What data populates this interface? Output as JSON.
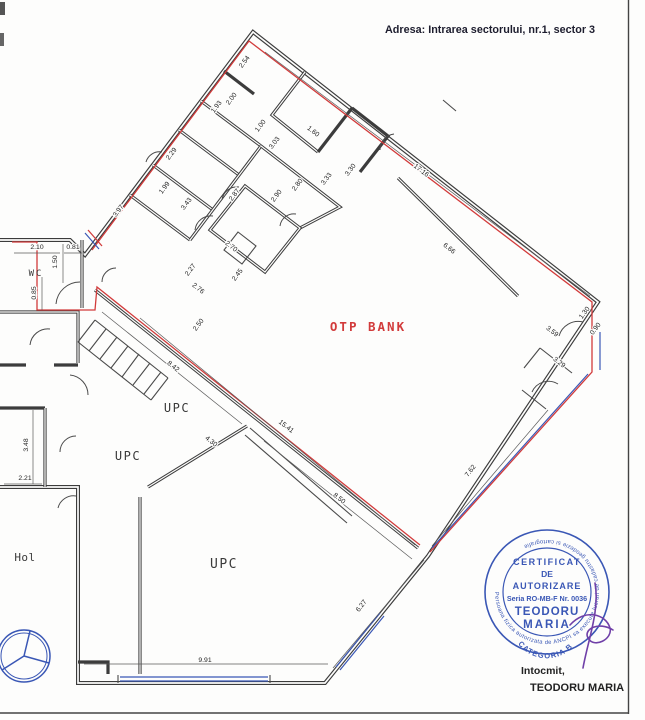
{
  "header": {
    "address": "Adresa: Intrarea sectorului, nr.1, sector 3"
  },
  "rooms": {
    "bank": "OTP BANK",
    "upc_a": "UPC",
    "upc_b": "UPC",
    "upc_c": "UPC",
    "hol": "Hol",
    "wc": "WC"
  },
  "dims": {
    "d01": "3.97",
    "d02": "1.99",
    "d03": "2.29",
    "d04": "1.93",
    "d05": "2.00",
    "d06": "2.54",
    "d07": "17.16",
    "d08": "1.00",
    "d09": "1.60",
    "d10": "3.03",
    "d11": "3.33",
    "d12": "3.30",
    "d13": "2.87",
    "d14": "2.90",
    "d15": "2.80",
    "d16": "3.43",
    "d17": "2.70",
    "d18": "2.45",
    "d19": "2.76",
    "d20": "2.27",
    "d21": "2.50",
    "d22": "8.42",
    "d23": "15.41",
    "d24": "4.30",
    "d25": "8.50",
    "d26": "6.66",
    "d27": "3.59",
    "d28": "3.29",
    "d29": "1.30",
    "d30": "0.90",
    "d31": "7.62",
    "d32": "6.27",
    "d33": "9.91",
    "d34": "2.21",
    "d35": "3.48",
    "d36": "2.10",
    "d37": "0.81",
    "d38": "1.50",
    "d39": "0.85"
  },
  "stamp": {
    "ring": "Persoana fizica autorizata de ANCPI sa execute lucrari de cadastru geodezie si cartografie",
    "line1": "CERTIFICAT",
    "line2": "DE",
    "line3": "AUTORIZARE",
    "line4": "Seria RO-MB-F Nr. 0036",
    "name1": "TEODORU",
    "name2": "MARIA",
    "category": "CATEGORIA B"
  },
  "footer": {
    "prepared_label": "Intocmit,",
    "prepared_name": "TEODORU MARIA"
  },
  "colors": {
    "red": "#d23b3b",
    "blue": "#3a57b5",
    "purple": "#7040a8",
    "ink": "#3c3c3c"
  }
}
